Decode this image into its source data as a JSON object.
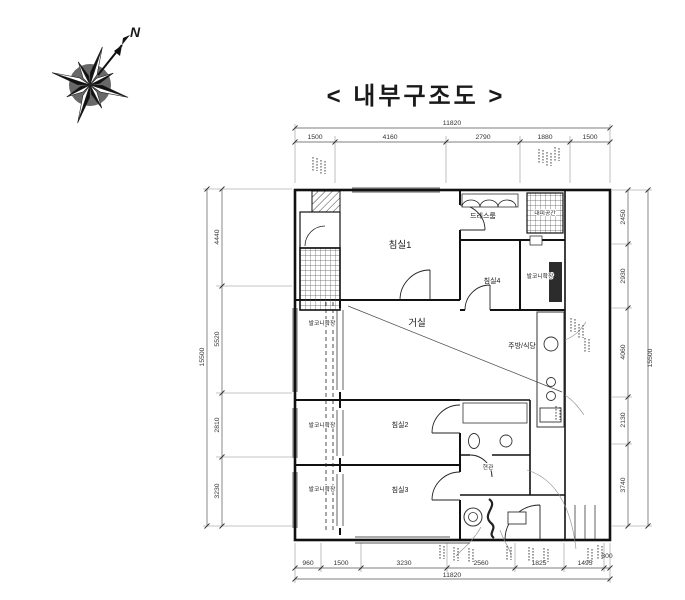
{
  "title": "< 내부구조도 >",
  "compass": {
    "north_label": "N"
  },
  "rooms": {
    "bedroom1": "침실1",
    "dressroom": "드레스룸",
    "refuge": "대피공간",
    "bedroom4": "침실4",
    "balcony_ext_right": "발코니확장",
    "living": "거실",
    "balcony_ext_living": "발코니확장",
    "kitchen": "주방/식당",
    "bedroom2": "침실2",
    "balcony_ext_bed2": "발코니확장",
    "bedroom3": "침실3",
    "balcony_ext_bed3": "발코니확장",
    "entrance": "현관"
  },
  "dimensions": {
    "top": {
      "total": "11820",
      "segments": [
        "1500",
        "4160",
        "2790",
        "1880",
        "1500"
      ]
    },
    "bottom": {
      "total": "11820",
      "segments": [
        "960",
        "1500",
        "3230",
        "2560",
        "1825",
        "1495",
        "300"
      ]
    },
    "left": {
      "total": "15500",
      "segments": [
        "4440",
        "5520",
        "2810",
        "3230"
      ]
    },
    "right": {
      "total": "15500",
      "segments": [
        "2450",
        "2930",
        "4060",
        "2130",
        "3740"
      ]
    }
  },
  "colors": {
    "ink": "#1a1a1a",
    "paper": "#ffffff",
    "dimline": "#555555"
  }
}
